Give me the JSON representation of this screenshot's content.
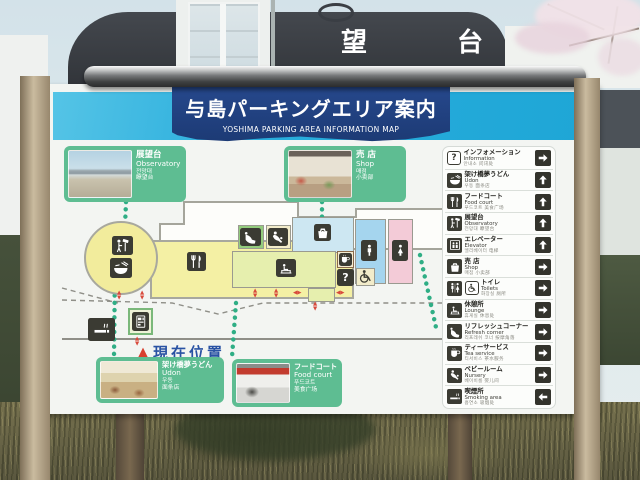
{
  "scene": {
    "background_building_sign": "展望台"
  },
  "sign": {
    "title_jp": "与島パーキングエリア案内",
    "title_en": "YOSHIMA PARKING AREA INFORMATION MAP",
    "current_position": {
      "marker": "▲",
      "label": "現在位置"
    },
    "photo_cards": [
      {
        "id": "observatory",
        "jp": "展望台",
        "en": "Observatory",
        "kr": "전망대",
        "cn": "瞭望台"
      },
      {
        "id": "shop",
        "jp": "売 店",
        "en": "Shop",
        "kr": "매점",
        "cn": "小卖部"
      },
      {
        "id": "udon",
        "jp": "架け橋夢うどん",
        "en": "Udon",
        "kr": "우동",
        "cn": "面条店"
      },
      {
        "id": "food-court",
        "jp": "フードコート",
        "en": "Food court",
        "kr": "푸드코트",
        "cn": "美食广场"
      }
    ],
    "legend": {
      "items": [
        {
          "jp": "インフォメーション",
          "en": "Information",
          "sub": "안내소 问讯处",
          "icon": "question",
          "glyph": "?",
          "arrow": "right"
        },
        {
          "jp": "架け橋夢うどん",
          "en": "Udon",
          "sub": "우동 面条店",
          "icon": "udon-bowl",
          "arrow": "up"
        },
        {
          "jp": "フードコート",
          "en": "Food court",
          "sub": "푸드코트 美食广场",
          "icon": "fork-knife",
          "arrow": "up"
        },
        {
          "jp": "展望台",
          "en": "Observatory",
          "sub": "전망대 瞭望台",
          "icon": "observatory",
          "arrow": "up"
        },
        {
          "jp": "エレベーター",
          "en": "Elevator",
          "sub": "엘리베이터 电梯",
          "icon": "elevator",
          "arrow": "up"
        },
        {
          "jp": "売 店",
          "en": "Shop",
          "sub": "매점 小卖部",
          "icon": "shopping-bag",
          "arrow": "right"
        },
        {
          "jp": "トイレ",
          "en": "Toilets",
          "sub": "화장실 厕所",
          "icon": "man-woman,wheelchair",
          "arrow": "right"
        },
        {
          "jp": "休憩所",
          "en": "Lounge",
          "sub": "휴게실 休息处",
          "icon": "lounge-bench",
          "arrow": "right"
        },
        {
          "jp": "リフレッシュコーナー",
          "en": "Refresh corner",
          "sub": "리프레쉬 코너 按摩角落",
          "icon": "massage-chair",
          "arrow": "right"
        },
        {
          "jp": "ティーサービス",
          "en": "Tea service",
          "sub": "티서비스 茶水服务",
          "icon": "tea-cup",
          "arrow": "right"
        },
        {
          "jp": "ベビールーム",
          "en": "Nursery",
          "sub": "베이비룸 婴儿间",
          "icon": "nursery-baby",
          "arrow": "right"
        },
        {
          "jp": "喫煙所",
          "en": "Smoking area",
          "sub": "흡연소 吸烟处",
          "icon": "smoking",
          "arrow": "left"
        }
      ]
    },
    "map_icons": [
      "observatory",
      "udon-bowl",
      "fork-knife",
      "massage-chair",
      "nursery-baby",
      "shopping-bag",
      "lounge-bench",
      "mens-toilet",
      "womens-toilet",
      "tea-cup",
      "information",
      "accessible-toilet",
      "smoking",
      "vending-machine"
    ]
  },
  "colors": {
    "banner_navy": "#20407c",
    "strip_cyan": "#2aaedd",
    "card_green": "#5ebd92",
    "route_green": "#2fae85",
    "arrow_red": "#d84a3c",
    "position_blue": "#2952a3"
  }
}
